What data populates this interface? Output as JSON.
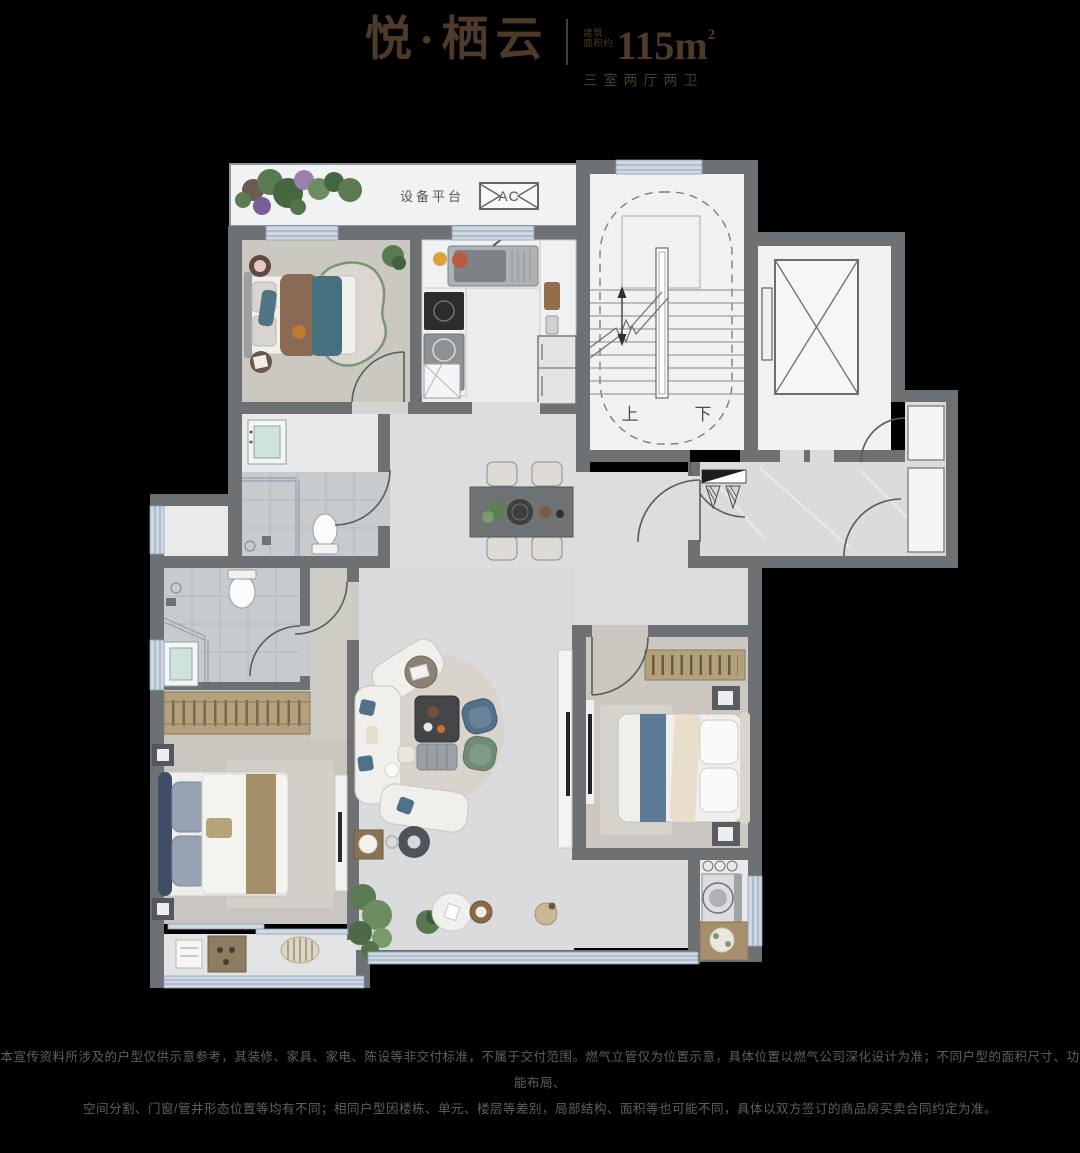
{
  "header": {
    "title": "悦·栖云",
    "area_prefix_top": "建筑",
    "area_prefix_bottom": "面积约",
    "area_value": "115m",
    "area_superscript": "2",
    "layout_spec": "三室两厅两卫"
  },
  "plan": {
    "labels": {
      "equipment_platform": "设备平台",
      "ac_unit": "AC",
      "stairs_up": "上",
      "stairs_down": "下"
    }
  },
  "footer": {
    "disclaimer_line1": "本宣传资料所涉及的户型仅供示意参考，其装修、家具、家电、陈设等非交付标准，不属于交付范围。燃气立管仅为位置示意，具体位置以燃气公司深化设计为准；不同户型的面积尺寸、功能布局、",
    "disclaimer_line2": "空间分割、门窗/管井形态位置等均有不同；相同户型因楼栋、单元、楼层等差别，局部结构、面积等也可能不同，具体以双方签订的商品房买卖合同约定为准。"
  },
  "colors": {
    "background": "#000000",
    "title_brown": "#4d3a28",
    "wall_gray": "#6e7174",
    "window_blue": "#cfd9e4",
    "disclaimer_gray": "#5d5f61"
  }
}
